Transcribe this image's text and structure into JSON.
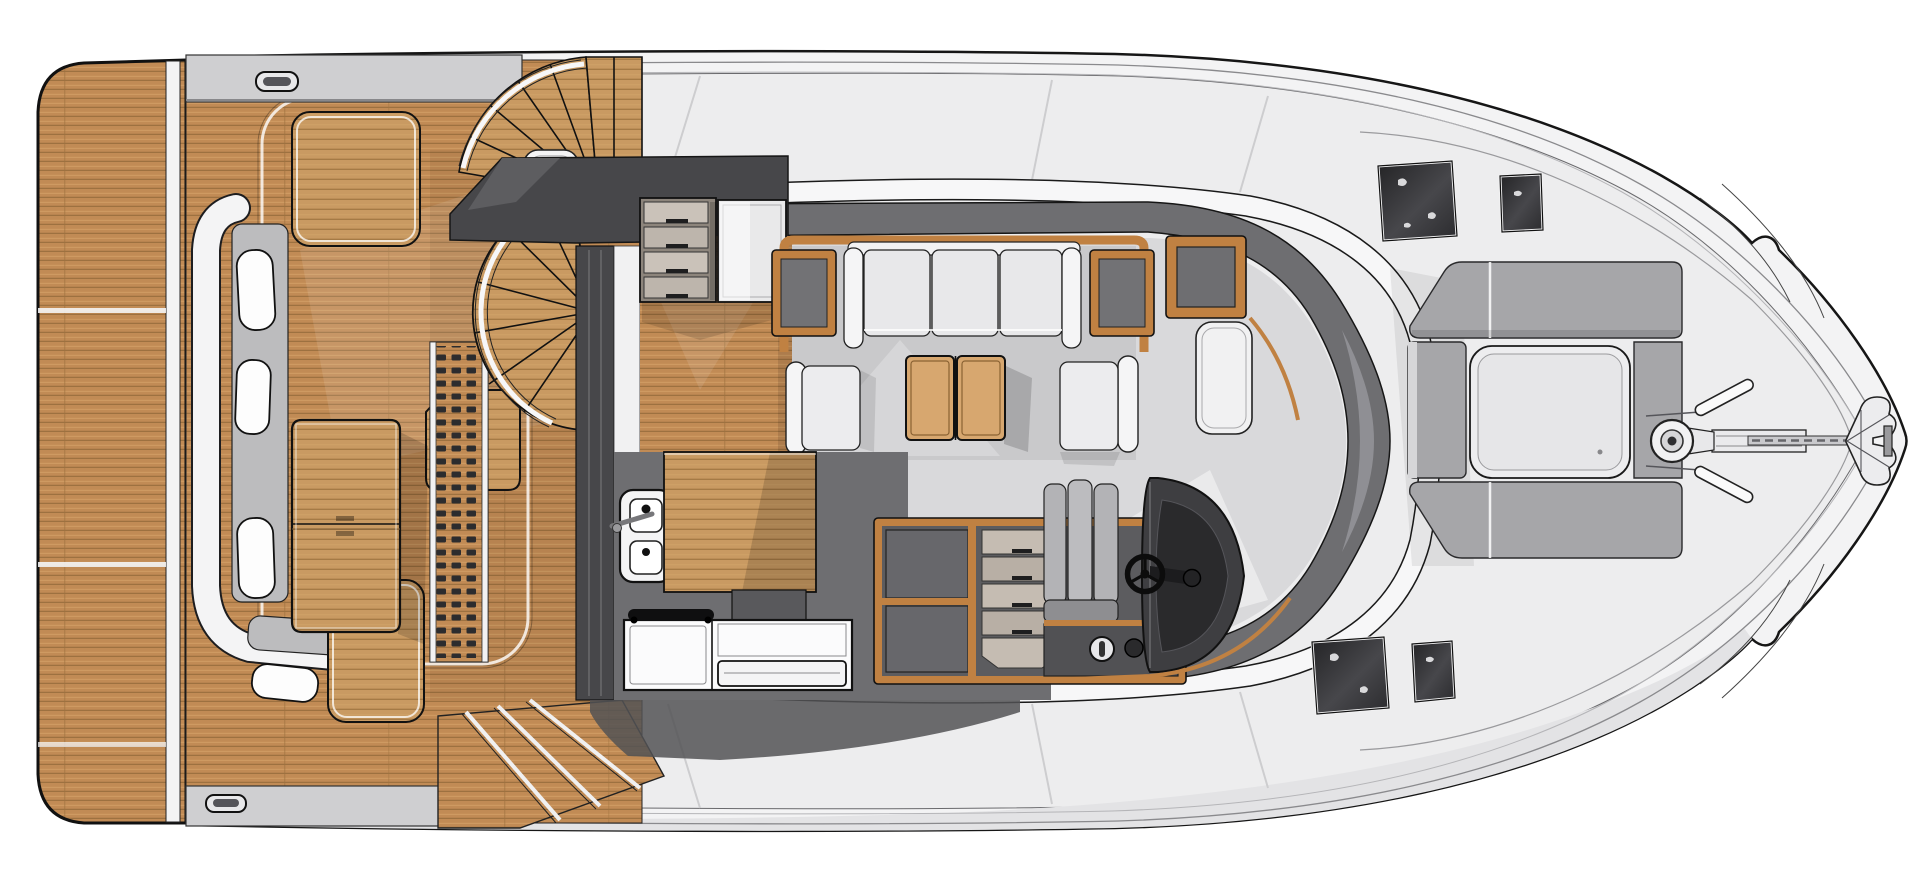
{
  "title": "Motor yacht main-deck floor plan, top view, bow to the right",
  "colors": {
    "hull": "#f3f3f4",
    "deck": "#ededee",
    "step": "#cfcfd1",
    "teak": "#c18b55",
    "teakDark": "#9d7140",
    "teakLight": "#daa96e",
    "teak2": "#c99a62",
    "teak2Dark": "#a57a45",
    "wood": "#c08142",
    "wood2": "#d7a76f",
    "charcoal": "#47474a",
    "wallgray": "#6e6e71",
    "floor": "#d9d9db",
    "floorInner": "#c9c9cb",
    "pad": "#a6a6a9",
    "seat": "#bcbcbe",
    "white": "#f6f6f7",
    "glassDark": "#323235",
    "glassLight": "#5c5c60",
    "outline": "#161616"
  },
  "regions": [
    {
      "id": "swim-platform",
      "label": "Teak swim platform (stern)"
    },
    {
      "id": "aft-deck",
      "label": "Aft cockpit with teak deck"
    },
    {
      "id": "cockpit-bench",
      "label": "Transom settee with cushions"
    },
    {
      "id": "cockpit-table",
      "label": "Folding teak cockpit table"
    },
    {
      "id": "flybridge-stairs",
      "label": "Curved steps up to flybridge"
    },
    {
      "id": "spiral-staircase",
      "label": "Spiral companionway stairs"
    },
    {
      "id": "deck-grating",
      "label": "Teak grating strip"
    },
    {
      "id": "sliding-door",
      "label": "Salon sliding door"
    },
    {
      "id": "galley",
      "label": "Galley with sink, counter and stove"
    },
    {
      "id": "salon",
      "label": "Main salon"
    },
    {
      "id": "sofa",
      "label": "Salon sofa with side tables"
    },
    {
      "id": "coffee-table",
      "label": "Two-leaf coffee table"
    },
    {
      "id": "armchair",
      "label": "Armchairs"
    },
    {
      "id": "helm-station",
      "label": "Inside helm station with wheel"
    },
    {
      "id": "windshield",
      "label": "Wrap-around windshield"
    },
    {
      "id": "side-deck",
      "label": "Side decks / walkways"
    },
    {
      "id": "foredeck",
      "label": "Foredeck with sun pads and skylight"
    },
    {
      "id": "deck-hatch",
      "label": "Dark glass deck hatches"
    },
    {
      "id": "bow",
      "label": "Bow with windlass and anchor"
    }
  ]
}
